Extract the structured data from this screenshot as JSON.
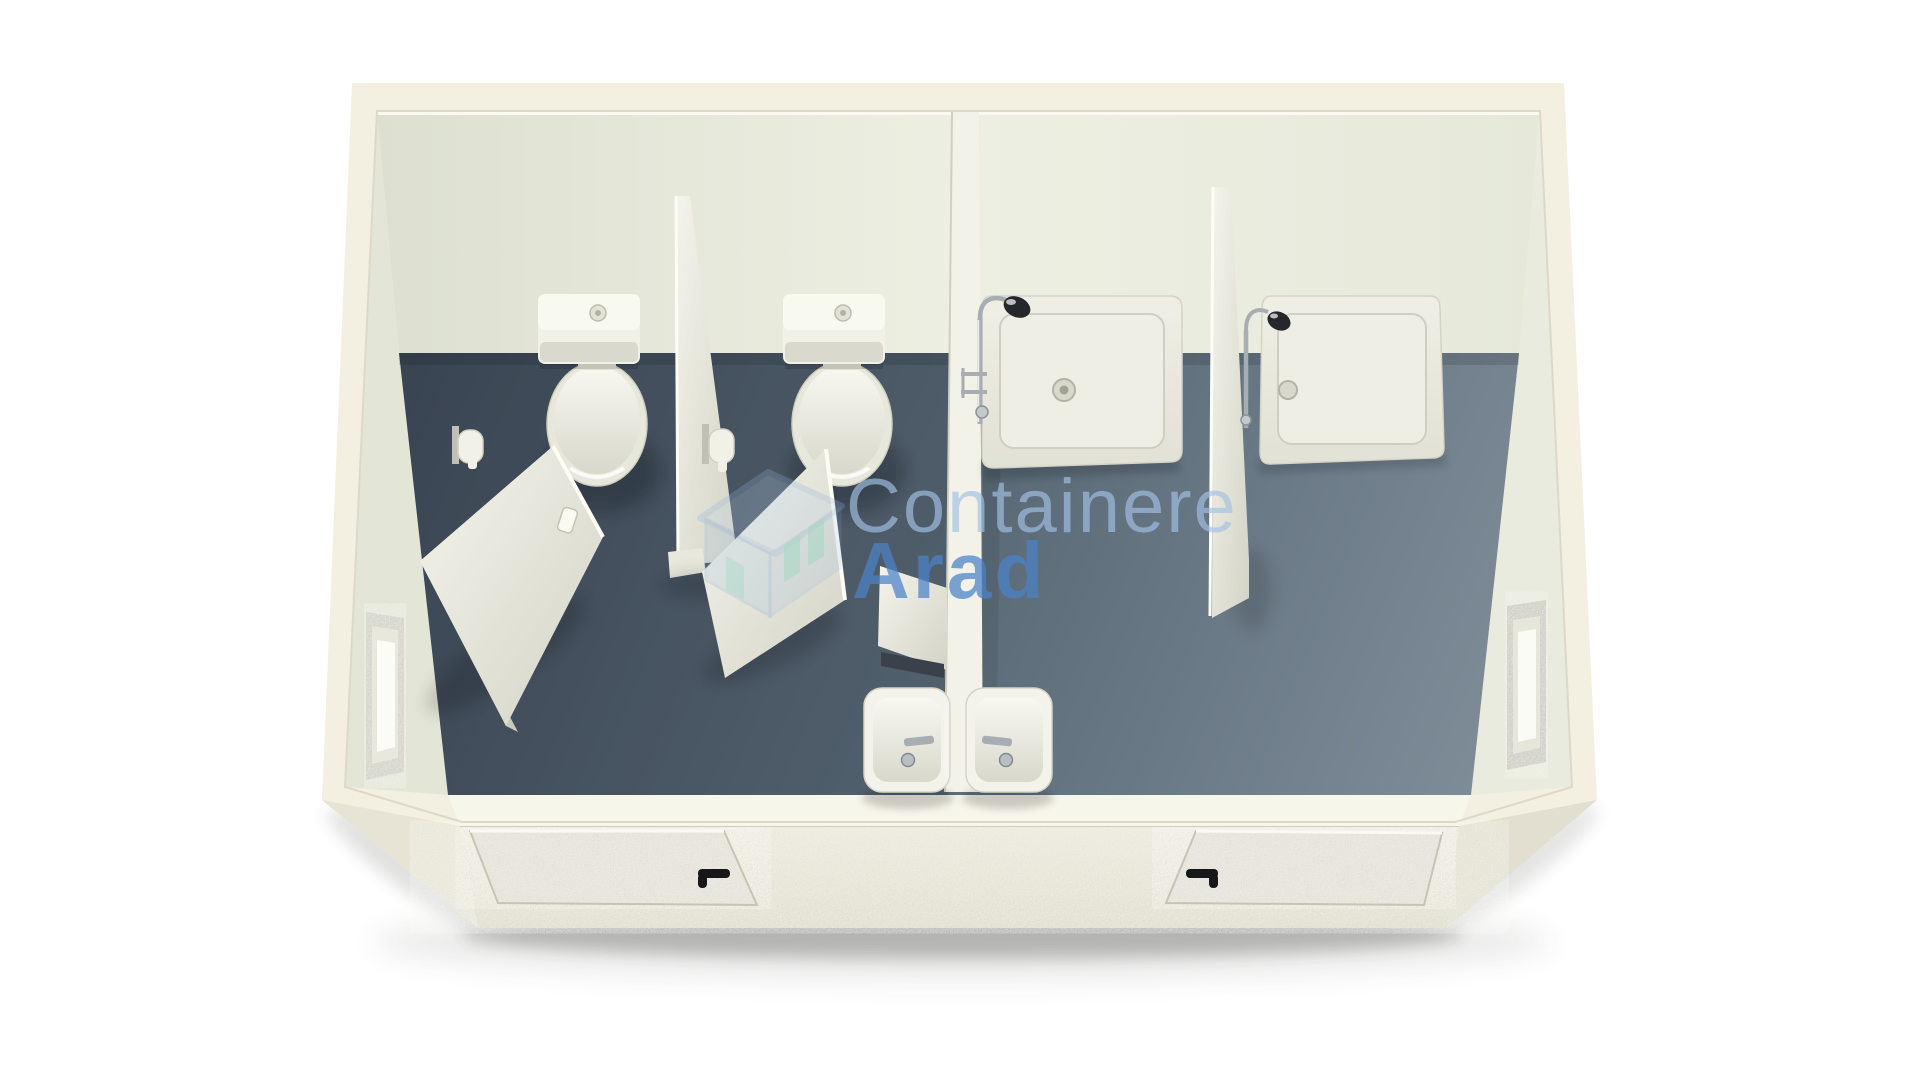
{
  "watermark": {
    "brand_line1": "Containere",
    "brand_line2": "Arad",
    "icon": "house-logo-icon"
  },
  "colors": {
    "background": "#ffffff",
    "shell": "#f3f0e2",
    "shell_shade": "#e7e4d5",
    "front_face": "#eae7d9",
    "door_texture": "#e0ded3",
    "wall_back": "#e9ebde",
    "wall_left": "#e3e6d7",
    "wall_right": "#e8ebdd",
    "front_band": "#f7f6eb",
    "floor_dark": "#3f4a58",
    "floor_light": "#7e8c98",
    "ceramic": "#f1f1e8",
    "ceramic_shade": "#d9d9cd",
    "partition": "#efefe6",
    "chrome": "#a7adb2",
    "shower_head": "#24272c",
    "handle": "#17171a",
    "mirror_slab": "#3a414b",
    "watermark_light": "#a3c2e6",
    "watermark_bold": "#4b83c8",
    "watermark_teal": "#7ecdb6"
  },
  "scene": {
    "type": "3d-render-top-view",
    "subject": "sanitary container with toilet room and shower room",
    "toilet_room": {
      "toilets": 2,
      "stall_partitions": 1,
      "stall_doors_open": 2,
      "toilet_paper_holders": 2,
      "washbasins": 1,
      "mirrors": 1,
      "windows": 1,
      "exterior_doors": 1
    },
    "shower_room": {
      "shower_trays": 2,
      "shower_partitions": 1,
      "shower_fittings": 2,
      "washbasins": 1,
      "windows": 1,
      "exterior_doors": 1
    }
  }
}
